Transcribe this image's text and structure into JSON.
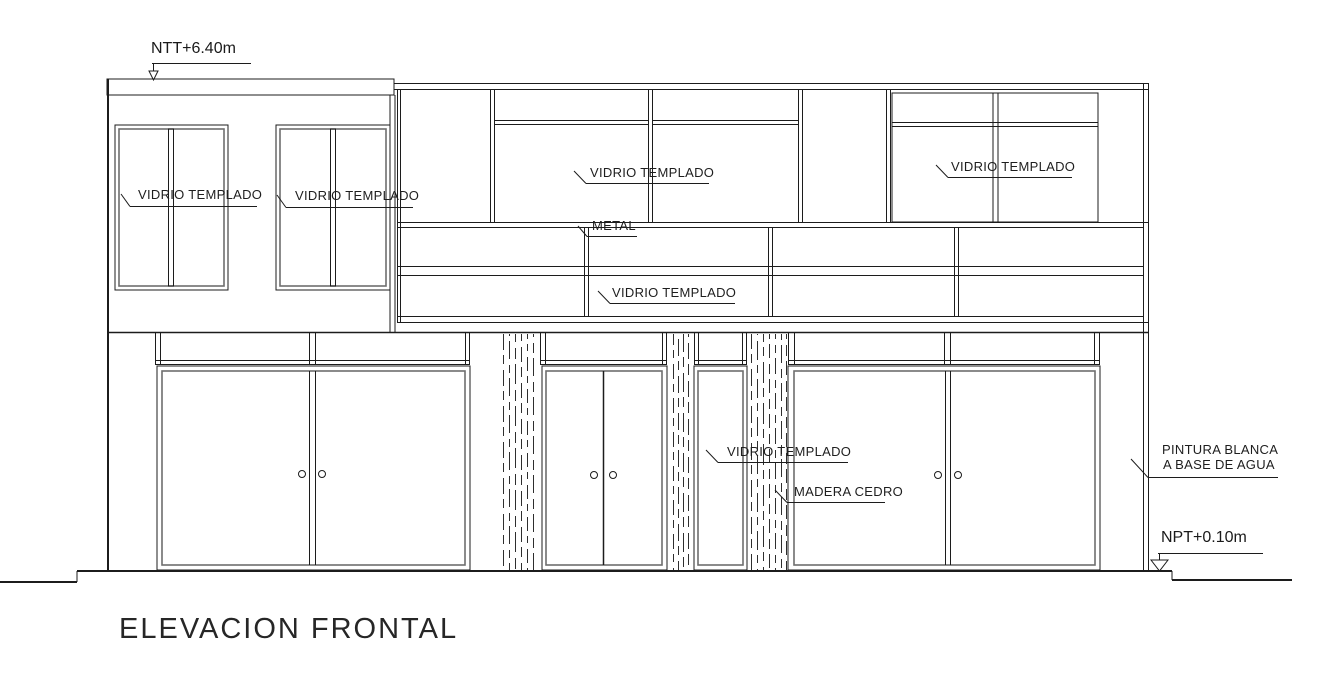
{
  "drawing": {
    "title": "ELEVACION FRONTAL",
    "levels": {
      "roof": "NTT+6.40m",
      "floor": "NPT+0.10m"
    },
    "materials": {
      "glass": "VIDRIO TEMPLADO",
      "metal": "METAL",
      "wood": "MADERA CEDRO",
      "paint_line1": "PINTURA BLANCA",
      "paint_line2": "A BASE DE AGUA"
    },
    "colors": {
      "line": "#1c1c1c",
      "background": "#ffffff"
    }
  }
}
